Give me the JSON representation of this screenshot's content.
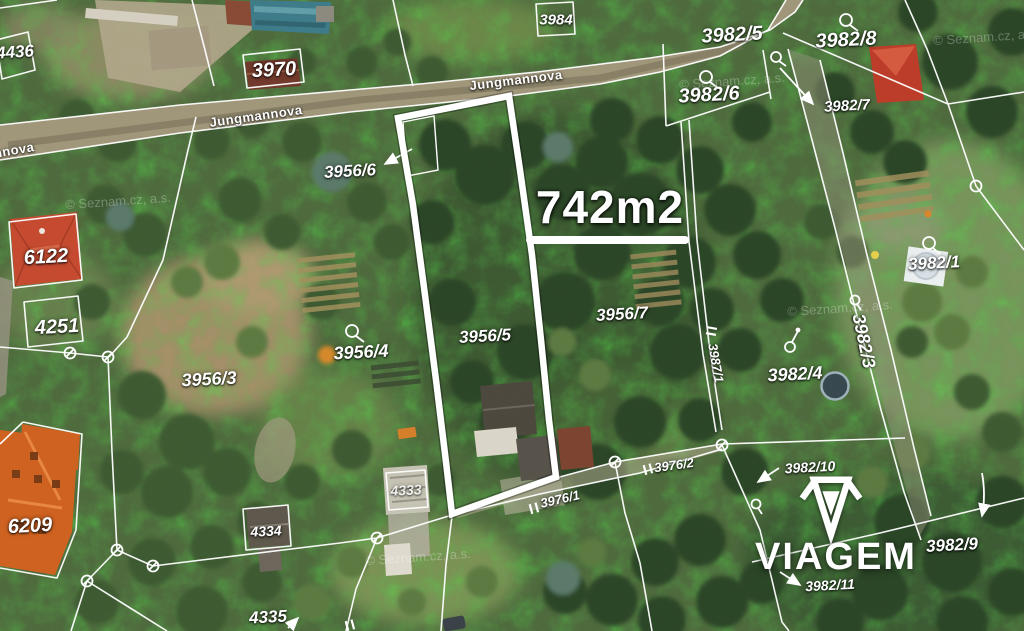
{
  "map": {
    "kind": "cadastral aerial view",
    "area_callout": {
      "text": "742m2",
      "x": 610,
      "y": 207,
      "size": 46
    },
    "brand": {
      "name": "VIAGEM",
      "x": 836,
      "y": 557,
      "size": 38
    },
    "street_labels": [
      {
        "text": "Jungmannova",
        "x": 256,
        "y": 116,
        "rot": -8,
        "size": 13
      },
      {
        "text": "Jungmannova",
        "x": 516,
        "y": 80,
        "rot": -7,
        "size": 13
      },
      {
        "text": "nnova",
        "x": 14,
        "y": 150,
        "rot": -10,
        "size": 13
      }
    ],
    "parcel_labels": [
      {
        "text": "4436",
        "x": 15,
        "y": 52,
        "size": 17,
        "rot": -4
      },
      {
        "text": "3970",
        "x": 274,
        "y": 70,
        "size": 20,
        "rot": -3
      },
      {
        "text": "3984",
        "x": 556,
        "y": 20,
        "size": 15,
        "rot": 0
      },
      {
        "text": "3982/5",
        "x": 732,
        "y": 35,
        "size": 20,
        "rot": -3
      },
      {
        "text": "3982/6",
        "x": 709,
        "y": 95,
        "size": 20,
        "rot": -3
      },
      {
        "text": "3982/8",
        "x": 846,
        "y": 40,
        "size": 20,
        "rot": -3
      },
      {
        "text": "3982/7",
        "x": 847,
        "y": 106,
        "size": 15,
        "rot": -3
      },
      {
        "text": "3956/6",
        "x": 350,
        "y": 171,
        "size": 17,
        "rot": -3
      },
      {
        "text": "6122",
        "x": 46,
        "y": 257,
        "size": 20,
        "rot": -3
      },
      {
        "text": "4251",
        "x": 57,
        "y": 327,
        "size": 20,
        "rot": -3
      },
      {
        "text": "3956/3",
        "x": 209,
        "y": 379,
        "size": 18,
        "rot": -3
      },
      {
        "text": "3956/4",
        "x": 361,
        "y": 352,
        "size": 18,
        "rot": -3
      },
      {
        "text": "3956/5",
        "x": 485,
        "y": 336,
        "size": 17,
        "rot": -3
      },
      {
        "text": "3956/7",
        "x": 622,
        "y": 314,
        "size": 17,
        "rot": -3
      },
      {
        "text": "3982/4",
        "x": 795,
        "y": 374,
        "size": 18,
        "rot": -3
      },
      {
        "text": "3982/3",
        "x": 864,
        "y": 341,
        "size": 18,
        "rot": 78
      },
      {
        "text": "3987/1",
        "x": 716,
        "y": 363,
        "size": 13,
        "rot": 80
      },
      {
        "text": "3982/1",
        "x": 934,
        "y": 263,
        "size": 17,
        "rot": -3
      },
      {
        "text": "6209",
        "x": 30,
        "y": 526,
        "size": 20,
        "rot": -3
      },
      {
        "text": "4334",
        "x": 266,
        "y": 531,
        "size": 14,
        "rot": -3
      },
      {
        "text": "4333",
        "x": 406,
        "y": 490,
        "size": 14,
        "rot": -3,
        "opacity": 0.75
      },
      {
        "text": "4335",
        "x": 268,
        "y": 617,
        "size": 17,
        "rot": -3
      },
      {
        "text": "3976/1",
        "x": 560,
        "y": 499,
        "size": 13,
        "rot": -13
      },
      {
        "text": "3976/2",
        "x": 674,
        "y": 465,
        "size": 13,
        "rot": -8
      },
      {
        "text": "3982/10",
        "x": 810,
        "y": 467,
        "size": 14,
        "rot": -3
      },
      {
        "text": "3982/11",
        "x": 830,
        "y": 585,
        "size": 14,
        "rot": -3
      },
      {
        "text": "3982/9",
        "x": 952,
        "y": 545,
        "size": 17,
        "rot": -3
      }
    ],
    "watermarks": [
      {
        "text": "© Seznam.cz, a.s.",
        "x": 118,
        "y": 201,
        "rot": -4
      },
      {
        "text": "© Seznam.cz, a.s.",
        "x": 732,
        "y": 81,
        "rot": -4
      },
      {
        "text": "© Seznam.cz, a.s.",
        "x": 986,
        "y": 37,
        "rot": -4
      },
      {
        "text": "© Seznam.cz, a.s.",
        "x": 840,
        "y": 308,
        "rot": -4
      },
      {
        "text": "© Seznam.cz, a.s.",
        "x": 418,
        "y": 557,
        "rot": -4
      }
    ]
  }
}
